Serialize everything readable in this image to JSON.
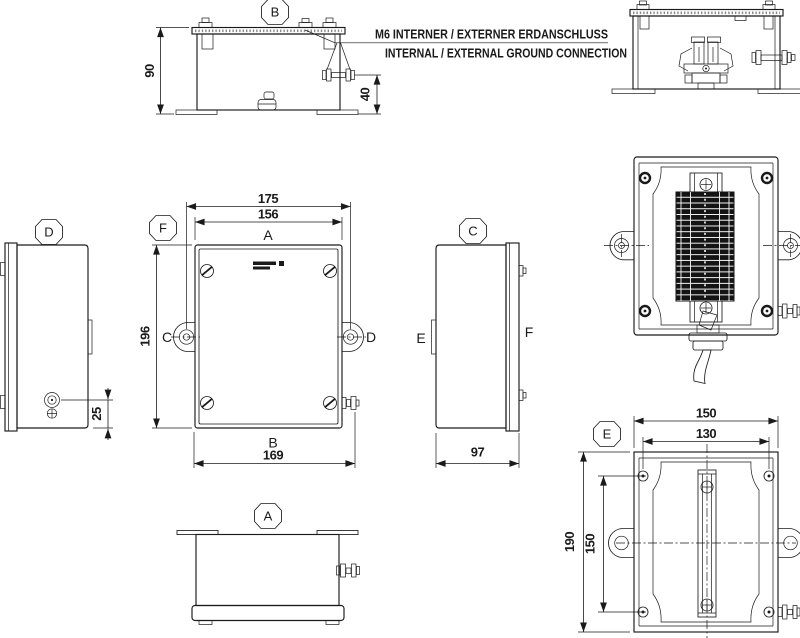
{
  "notes": {
    "line1": "M6 INTERNER / EXTERNER ERDANSCHLUSS",
    "line2": "INTERNAL / EXTERNAL GROUND CONNECTION"
  },
  "views": {
    "b": {
      "label": "B",
      "height": "90",
      "ground_height": "40"
    },
    "d": {
      "label": "D",
      "ground_offset": "25"
    },
    "f": {
      "label": "F",
      "lug_span": "175",
      "width": "156",
      "face_top": "A",
      "face_left": "C",
      "face_right": "D",
      "height": "196",
      "face_bottom": "B",
      "base_width": "169"
    },
    "c": {
      "label": "C",
      "face_left": "E",
      "face_right": "F",
      "depth": "97"
    },
    "a": {
      "label": "A"
    },
    "e": {
      "label": "E",
      "outer_width": "150",
      "hole_span_h": "130",
      "outer_height": "190",
      "hole_span_v": "150"
    }
  },
  "colors": {
    "line": "#1a1a1a",
    "background": "#ffffff"
  }
}
